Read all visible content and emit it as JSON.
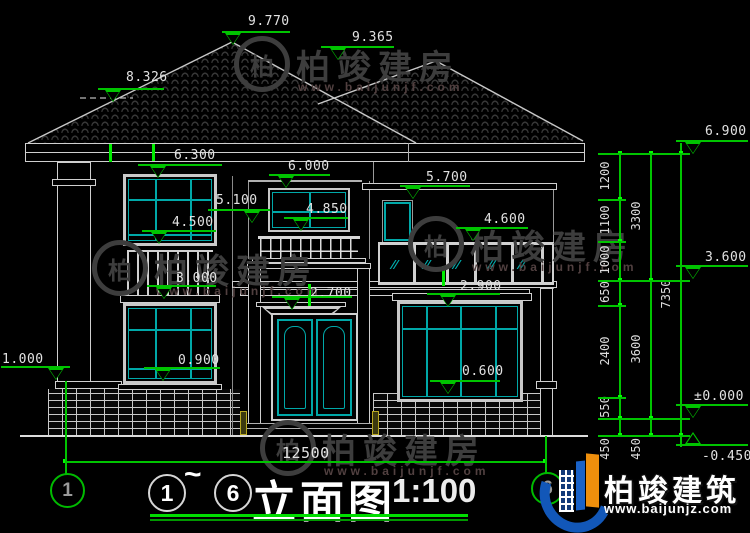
{
  "page": {
    "width": 750,
    "height": 533,
    "background": "#000000"
  },
  "title_block": {
    "axis_start": "1",
    "tilde": "~",
    "axis_end": "6",
    "title": "立面图",
    "scale": "1:100"
  },
  "grid_bubbles": [
    {
      "label": "1",
      "x": 50,
      "y": 473,
      "d": 31
    },
    {
      "label": "6",
      "x": 531,
      "y": 472,
      "d": 29
    }
  ],
  "elevation_markers": [
    {
      "value": "9.770",
      "tx": 248,
      "ty": 14,
      "lx1": 222,
      "lx2": 290,
      "ly": 31,
      "trix": 233,
      "dir": "down"
    },
    {
      "value": "9.365",
      "tx": 352,
      "ty": 30,
      "lx1": 321,
      "lx2": 394,
      "ly": 46,
      "trix": 338,
      "dir": "down"
    },
    {
      "value": "8.326",
      "tx": 126,
      "ty": 70,
      "lx1": 98,
      "lx2": 164,
      "ly": 88,
      "trix": 113,
      "dir": "down"
    },
    {
      "value": "6.300",
      "tx": 174,
      "ty": 148,
      "lx1": 138,
      "lx2": 222,
      "ly": 164,
      "trix": 158,
      "dir": "down"
    },
    {
      "value": "6.000",
      "tx": 288,
      "ty": 159,
      "lx1": 269,
      "lx2": 330,
      "ly": 174,
      "trix": 286,
      "dir": "down"
    },
    {
      "value": "5.700",
      "tx": 426,
      "ty": 170,
      "lx1": 400,
      "lx2": 470,
      "ly": 185,
      "trix": 413,
      "dir": "down"
    },
    {
      "value": "5.100",
      "tx": 216,
      "ty": 193,
      "lx1": 208,
      "lx2": 270,
      "ly": 209,
      "trix": 252,
      "dir": "down"
    },
    {
      "value": "4.850",
      "tx": 306,
      "ty": 202,
      "lx1": 284,
      "lx2": 348,
      "ly": 217,
      "trix": 301,
      "dir": "down"
    },
    {
      "value": "4.600",
      "tx": 484,
      "ty": 212,
      "lx1": 456,
      "lx2": 528,
      "ly": 227,
      "trix": 473,
      "dir": "down"
    },
    {
      "value": "4.500",
      "tx": 172,
      "ty": 215,
      "lx1": 142,
      "lx2": 216,
      "ly": 230,
      "trix": 159,
      "dir": "down"
    },
    {
      "value": "3.000",
      "tx": 176,
      "ty": 271,
      "lx1": 147,
      "lx2": 216,
      "ly": 285,
      "trix": 164,
      "dir": "down"
    },
    {
      "value": "2.700",
      "tx": 310,
      "ty": 286,
      "lx1": 272,
      "lx2": 352,
      "ly": 296,
      "trix": 292,
      "dir": "down"
    },
    {
      "value": "2.900",
      "tx": 460,
      "ty": 279,
      "lx1": 427,
      "lx2": 500,
      "ly": 293,
      "trix": 448,
      "dir": "down"
    },
    {
      "value": "1.000",
      "tx": 2,
      "ty": 352,
      "lx1": 1,
      "lx2": 70,
      "ly": 366,
      "trix": 56,
      "dir": "down"
    },
    {
      "value": "0.900",
      "tx": 178,
      "ty": 353,
      "lx1": 144,
      "lx2": 220,
      "ly": 367,
      "trix": 163,
      "dir": "down"
    },
    {
      "value": "0.600",
      "tx": 462,
      "ty": 364,
      "lx1": 430,
      "lx2": 500,
      "ly": 380,
      "trix": 448,
      "dir": "down"
    },
    {
      "value": "6.900",
      "tx": 705,
      "ty": 124,
      "lx1": 676,
      "lx2": 748,
      "ly": 140,
      "trix": 693,
      "dir": "down"
    },
    {
      "value": "3.600",
      "tx": 705,
      "ty": 250,
      "lx1": 676,
      "lx2": 748,
      "ly": 265,
      "trix": 693,
      "dir": "down"
    },
    {
      "value": "±0.000",
      "tx": 694,
      "ty": 389,
      "lx1": 676,
      "lx2": 748,
      "ly": 404,
      "trix": 693,
      "dir": "down"
    },
    {
      "value": "-0.450",
      "tx": 702,
      "ty": 449,
      "lx1": 676,
      "lx2": 748,
      "ly": 444,
      "trix": 693,
      "dir": "up"
    }
  ],
  "vertical_dim_chains": [
    {
      "x": 619,
      "y1": 153,
      "y2": 435,
      "labelx": 605,
      "ticks": [
        153,
        199,
        241,
        280,
        305,
        397,
        418,
        435
      ],
      "labels": [
        {
          "v": "1200",
          "cy": 176
        },
        {
          "v": "1100",
          "cy": 220
        },
        {
          "v": "1000",
          "cy": 260
        },
        {
          "v": "650",
          "cy": 292
        },
        {
          "v": "2400",
          "cy": 351
        },
        {
          "v": "550",
          "cy": 407
        },
        {
          "v": "450",
          "cy": 449
        }
      ]
    },
    {
      "x": 650,
      "y1": 153,
      "y2": 435,
      "labelx": 636,
      "ticks": [
        153,
        280,
        418,
        435
      ],
      "labels": [
        {
          "v": "3300",
          "cy": 216
        },
        {
          "v": "3600",
          "cy": 349
        },
        {
          "v": "450",
          "cy": 449
        }
      ]
    },
    {
      "x": 680,
      "y1": 143,
      "y2": 447,
      "labelx": 666,
      "ticks": [
        153,
        435
      ],
      "labels": [
        {
          "v": "7350",
          "cy": 294
        }
      ]
    }
  ],
  "horizontal_ticks": [
    {
      "y": 153,
      "x1": 598,
      "x2": 690
    },
    {
      "y": 199,
      "x1": 598,
      "x2": 626
    },
    {
      "y": 241,
      "x1": 598,
      "x2": 626
    },
    {
      "y": 280,
      "x1": 598,
      "x2": 690
    },
    {
      "y": 305,
      "x1": 598,
      "x2": 626
    },
    {
      "y": 397,
      "x1": 598,
      "x2": 626
    },
    {
      "y": 418,
      "x1": 598,
      "x2": 690
    },
    {
      "y": 435,
      "x1": 598,
      "x2": 690
    }
  ],
  "bottom_dim": {
    "label": "12500",
    "y": 461,
    "x1": 65,
    "x2": 545,
    "label_x": 282,
    "label_y": 444,
    "droppers": [
      {
        "x": 65,
        "y1": 381,
        "y2": 474
      },
      {
        "x": 545,
        "y1": 436,
        "y2": 473
      }
    ]
  },
  "watermark": {
    "brand": "柏竣建房",
    "url": "www.baijunjf.com",
    "monogram": "柏",
    "positions": [
      {
        "x": 234,
        "y": 36
      },
      {
        "x": 92,
        "y": 240
      },
      {
        "x": 408,
        "y": 216
      },
      {
        "x": 260,
        "y": 420
      }
    ]
  },
  "logo": {
    "brand": "柏竣建筑",
    "url": "www.baijunjz.com"
  },
  "colors": {
    "dimension_green": "#00c400",
    "bright_green": "#00ff00",
    "window_teal": "#00a8a8",
    "line_white": "#d4d4d4",
    "step_yellow": "#b8a820",
    "logo_blue": "#1257b8",
    "logo_orange": "#ef8f0c"
  }
}
